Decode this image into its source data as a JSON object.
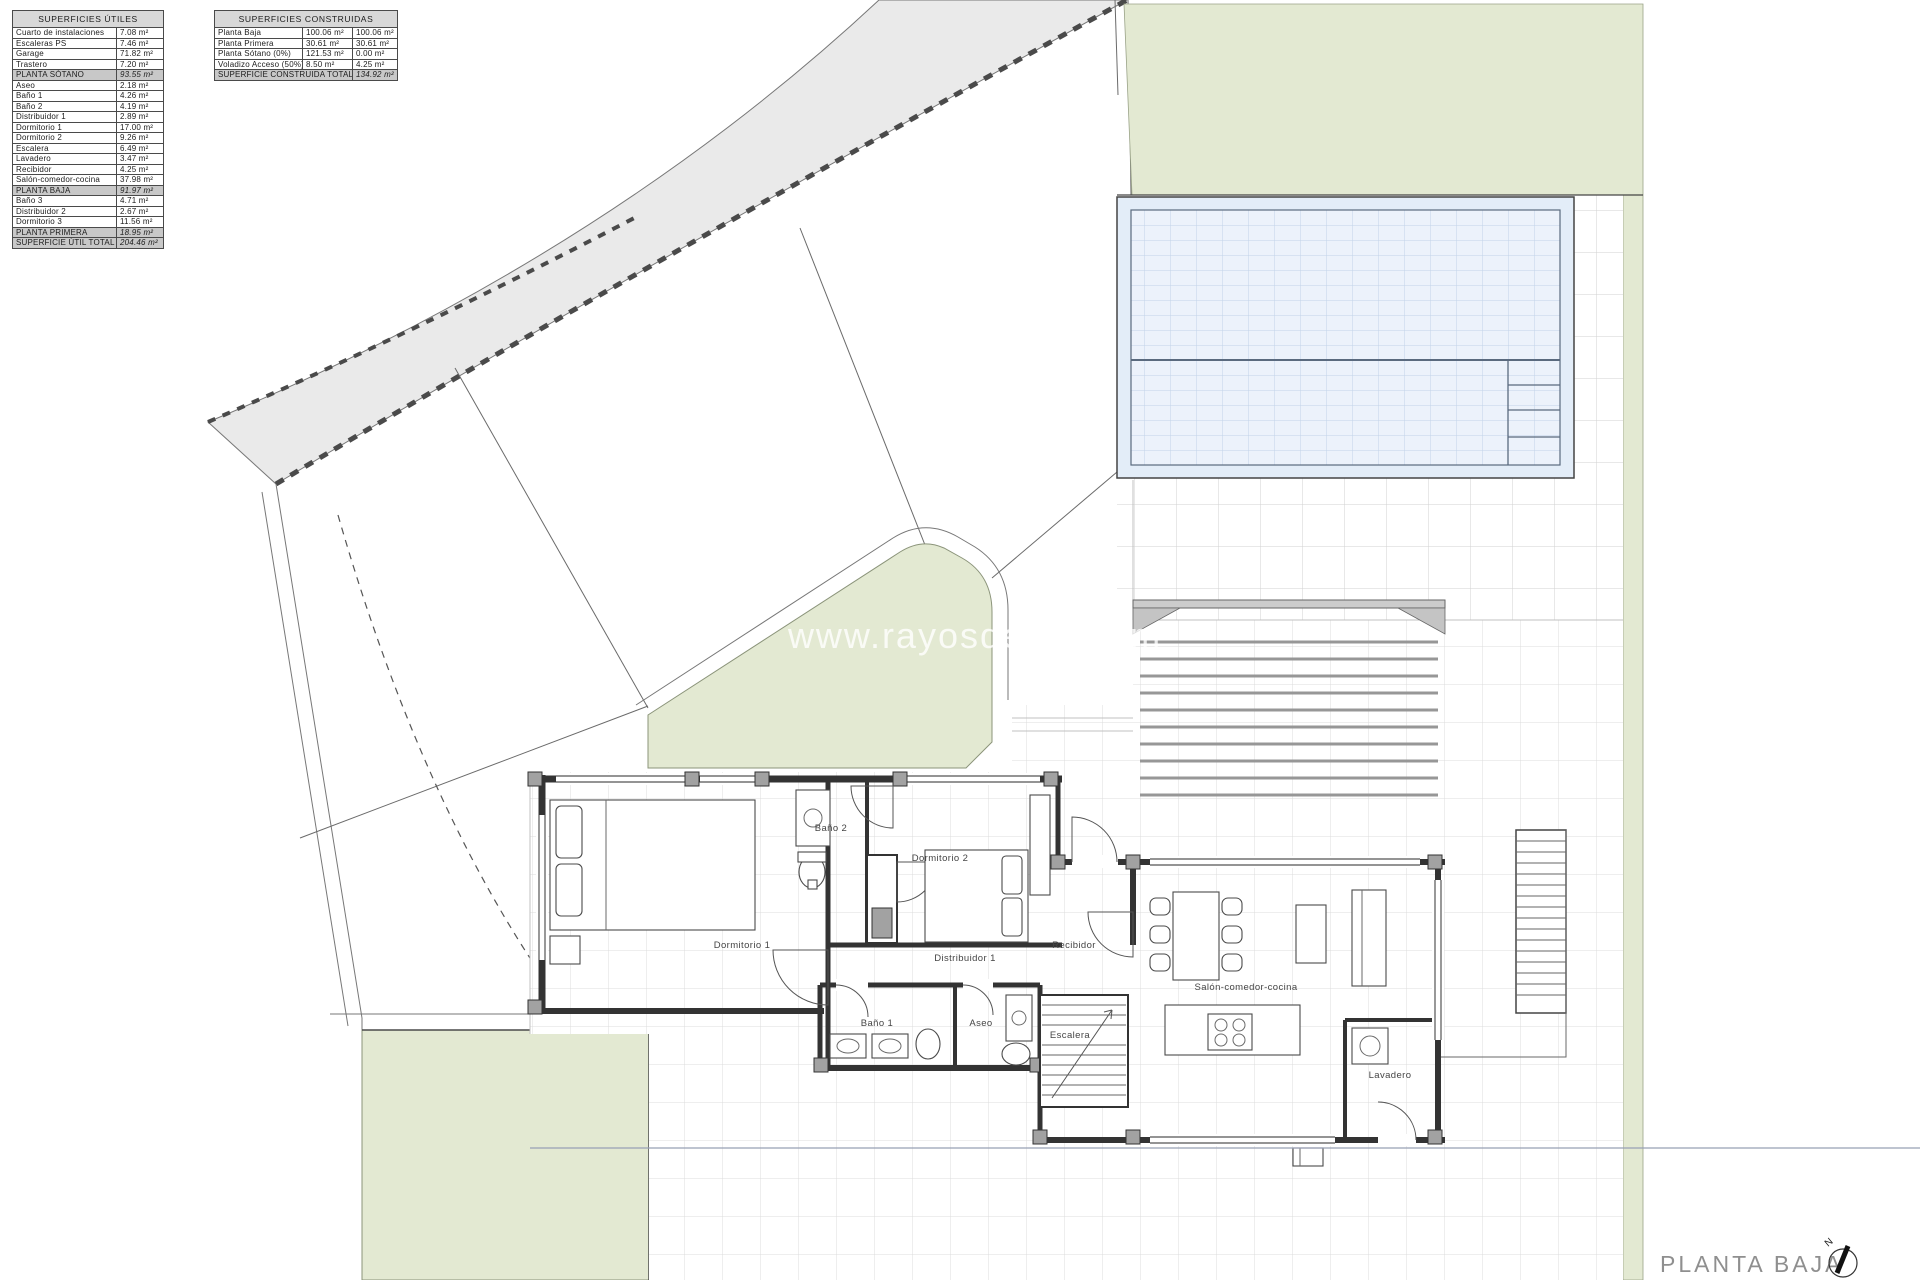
{
  "tables": {
    "superficies_utiles": {
      "title": "SUPERFICIES ÚTILES",
      "rows": [
        {
          "label": "Cuarto de instalaciones",
          "value": "7.08 m²",
          "type": "item"
        },
        {
          "label": "Escaleras PS",
          "value": "7.46 m²",
          "type": "item"
        },
        {
          "label": "Garage",
          "value": "71.82 m²",
          "type": "item"
        },
        {
          "label": "Trastero",
          "value": "7.20 m²",
          "type": "item"
        },
        {
          "label": "PLANTA SÓTANO",
          "value": "93.55 m²",
          "type": "subtotal"
        },
        {
          "label": "Aseo",
          "value": "2.18 m²",
          "type": "item"
        },
        {
          "label": "Baño 1",
          "value": "4.26 m²",
          "type": "item"
        },
        {
          "label": "Baño 2",
          "value": "4.19 m²",
          "type": "item"
        },
        {
          "label": "Distribuidor 1",
          "value": "2.89 m²",
          "type": "item"
        },
        {
          "label": "Dormitorio 1",
          "value": "17.00 m²",
          "type": "item"
        },
        {
          "label": "Dormitorio 2",
          "value": "9.26 m²",
          "type": "item"
        },
        {
          "label": "Escalera",
          "value": "6.49 m²",
          "type": "item"
        },
        {
          "label": "Lavadero",
          "value": "3.47 m²",
          "type": "item"
        },
        {
          "label": "Recibidor",
          "value": "4.25 m²",
          "type": "item"
        },
        {
          "label": "Salón-comedor-cocina",
          "value": "37.98 m²",
          "type": "item"
        },
        {
          "label": "PLANTA BAJA",
          "value": "91.97 m²",
          "type": "subtotal"
        },
        {
          "label": "Baño 3",
          "value": "4.71 m²",
          "type": "item"
        },
        {
          "label": "Distribuidor 2",
          "value": "2.67 m²",
          "type": "item"
        },
        {
          "label": "Dormitorio 3",
          "value": "11.56 m²",
          "type": "item"
        },
        {
          "label": "PLANTA PRIMERA",
          "value": "18.95 m²",
          "type": "subtotal"
        },
        {
          "label": "SUPERFICIE ÚTIL TOTAL",
          "value": "204.46 m²",
          "type": "total"
        }
      ]
    },
    "superficies_construidas": {
      "title": "SUPERFICIES CONSTRUIDAS",
      "rows": [
        {
          "label": "Planta Baja",
          "v1": "100.06 m²",
          "v2": "100.06 m²",
          "type": "item"
        },
        {
          "label": "Planta Primera",
          "v1": "30.61 m²",
          "v2": "30.61 m²",
          "type": "item"
        },
        {
          "label": "Planta Sótano (0%)",
          "v1": "121.53 m²",
          "v2": "0.00 m²",
          "type": "item"
        },
        {
          "label": "Voladizo Acceso (50%)",
          "v1": "8.50 m²",
          "v2": "4.25 m²",
          "type": "item"
        }
      ],
      "total": {
        "label": "SUPERFICIE CONSTRUIDA TOTAL",
        "value": "134.92 m²"
      }
    }
  },
  "plan": {
    "labels": {
      "dormitorio_1": "Dormitorio 1",
      "bano_2": "Baño 2",
      "dormitorio_2": "Dormitorio 2",
      "distribuidor_1": "Distribuidor 1",
      "recibidor": "Recibidor",
      "salon": "Salón-comedor-cocina",
      "escalera": "Escalera",
      "bano_1": "Baño 1",
      "aseo": "Aseo",
      "lavadero": "Lavadero"
    },
    "watermark": "www.rayosdesol.com",
    "caption": "PLANTA BAJA",
    "north_label": "N"
  },
  "colors": {
    "green": "#e3e9d2",
    "road": "#eaeaea",
    "pool_fill": "#e3edf8",
    "pool_inner": "#ecf2fb",
    "pool_grid": "#c2d3e8",
    "wall": "#333333",
    "grid_line": "#dcdcdc",
    "deck_grid": "#d2d2d2",
    "table_shaded": "#c8c8c8",
    "caption_gray": "#8f8f8f"
  }
}
